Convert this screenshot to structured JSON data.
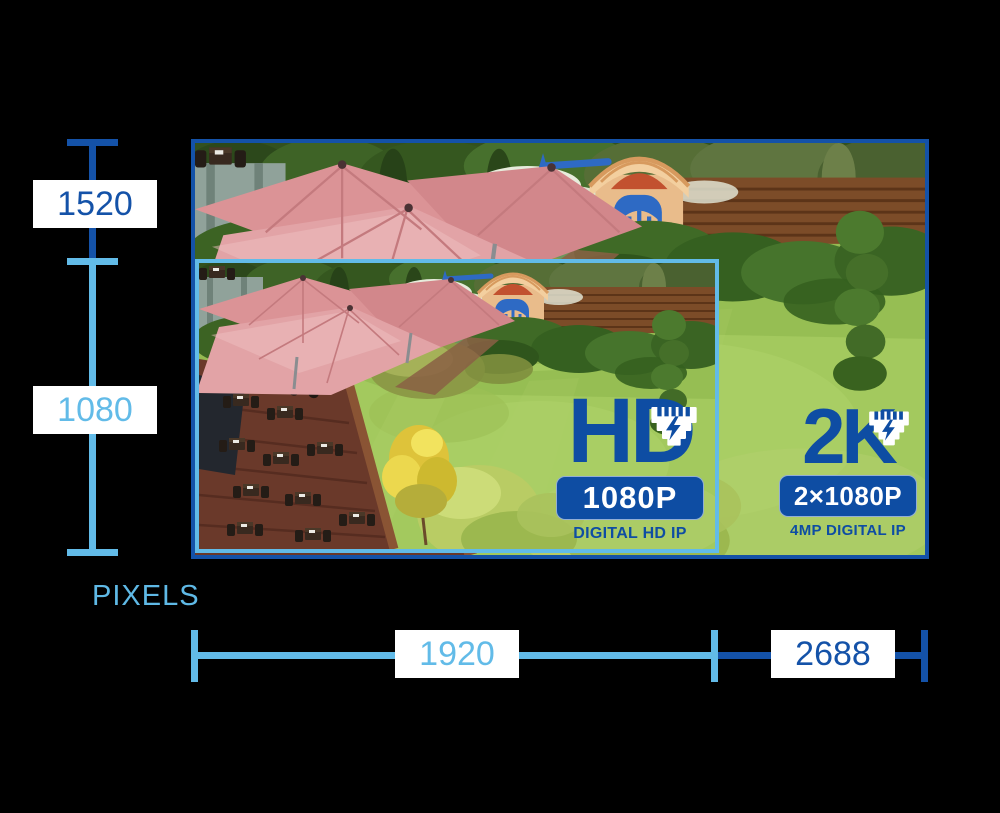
{
  "background_color": "#000000",
  "colors": {
    "dark_blue": "#1452a8",
    "light_blue": "#62bbe8",
    "logo_blue": "#0e4da3",
    "label_background": "#ffffff"
  },
  "measurements": {
    "axis_caption": "PIXELS",
    "vertical": [
      {
        "label": "1520",
        "tone": "dark",
        "refers_to": "2K frame height"
      },
      {
        "label": "1080",
        "tone": "light",
        "refers_to": "HD frame height"
      }
    ],
    "horizontal": [
      {
        "label": "1920",
        "tone": "light",
        "refers_to": "HD frame width"
      },
      {
        "label": "2688",
        "tone": "dark",
        "refers_to": "2K frame width"
      }
    ]
  },
  "photo": {
    "description": "Aerial garden scene: red patio umbrellas over a wooden restaurant deck with wicker furniture, a playground with tan playhouse and blue swing, hedges, a large lawn, spiral topiary and wooden fence"
  },
  "logos": {
    "hd": {
      "title": "HD",
      "badge": "1080P",
      "caption": "DIGITAL HD IP"
    },
    "tk": {
      "title": "2K",
      "badge": "2×1080P",
      "caption": "4MP DIGITAL IP"
    }
  }
}
